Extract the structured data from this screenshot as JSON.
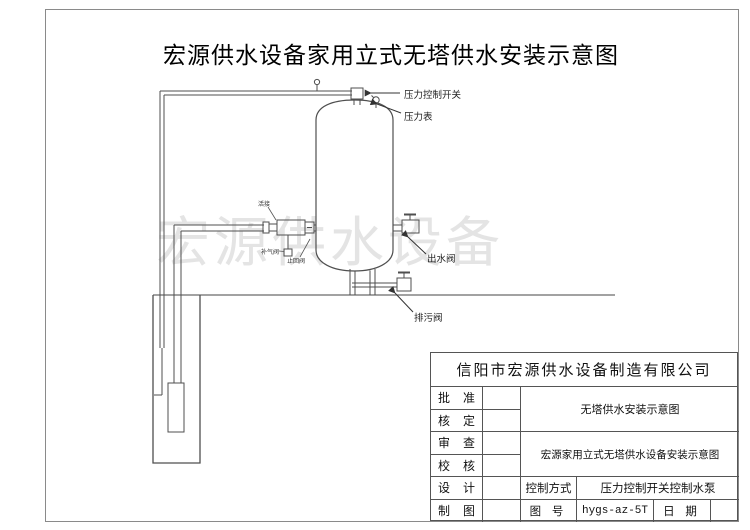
{
  "page": {
    "title": "宏源供水设备家用立式无塔供水安装示意图",
    "watermark": "宏源供水设备"
  },
  "diagram": {
    "labels": {
      "pressure_switch": "压力控制开关",
      "pressure_gauge": "压力表",
      "outlet_valve": "出水阀",
      "drain_valve": "排污阀",
      "union": "活接",
      "air_valve": "补气阀",
      "check_valve": "止回阀"
    }
  },
  "title_block": {
    "company": "信阳市宏源供水设备制造有限公司",
    "row_labels": [
      "批 准",
      "核 定",
      "审 查",
      "校 核",
      "设 计",
      "制 图"
    ],
    "doc1": "无塔供水安装示意图",
    "doc2": "宏源家用立式无塔供水设备安装示意图",
    "control_label": "控制方式",
    "control_value": "压力控制开关控制水泵",
    "drawing_no_label": "图 号",
    "drawing_no": "hygs-az-5T",
    "date_label": "日 期",
    "date_value": ""
  },
  "colors": {
    "line": "#4f4f4f",
    "frame": "#8a8a8a",
    "watermark": "#e4e4e4",
    "text": "#1a1a1a"
  }
}
